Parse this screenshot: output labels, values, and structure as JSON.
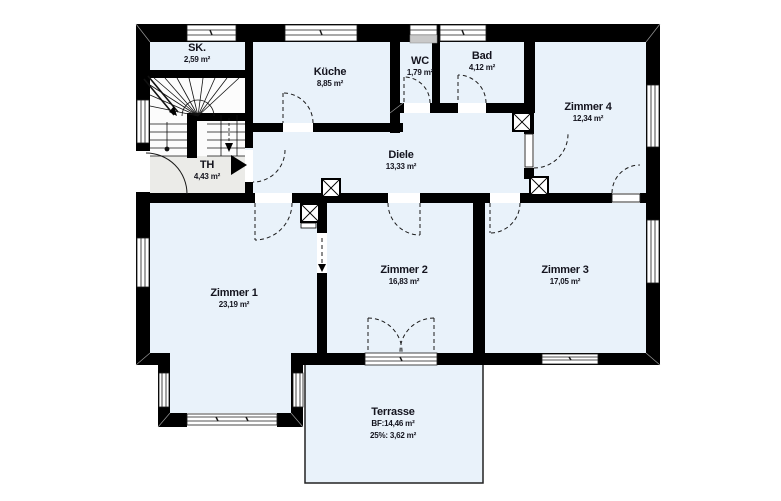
{
  "building": {
    "rooms": [
      {
        "id": "sk",
        "name": "SK.",
        "area": "2,59 m²"
      },
      {
        "id": "kueche",
        "name": "Küche",
        "area": "8,85 m²"
      },
      {
        "id": "wc",
        "name": "WC",
        "area": "1,79 m²"
      },
      {
        "id": "bad",
        "name": "Bad",
        "area": "4,12 m²"
      },
      {
        "id": "zimmer4",
        "name": "Zimmer 4",
        "area": "12,34 m²"
      },
      {
        "id": "diele",
        "name": "Diele",
        "area": "13,33 m²"
      },
      {
        "id": "th",
        "name": "TH",
        "area": "4,43 m²"
      },
      {
        "id": "zimmer1",
        "name": "Zimmer 1",
        "area": "23,19 m²"
      },
      {
        "id": "zimmer2",
        "name": "Zimmer 2",
        "area": "16,83 m²"
      },
      {
        "id": "zimmer3",
        "name": "Zimmer 3",
        "area": "17,05 m²"
      }
    ],
    "terrace": {
      "name": "Terrasse",
      "line1": "BF:14,46 m²",
      "line2": "25%: 3,62 m²"
    },
    "colors": {
      "wall": "#000000",
      "room_fill": "#e9f2fa",
      "hall_fill": "#ebebe8",
      "stair_fill": "#fcfcfc",
      "text": "#14141e",
      "line": "#1a1a1a"
    }
  }
}
